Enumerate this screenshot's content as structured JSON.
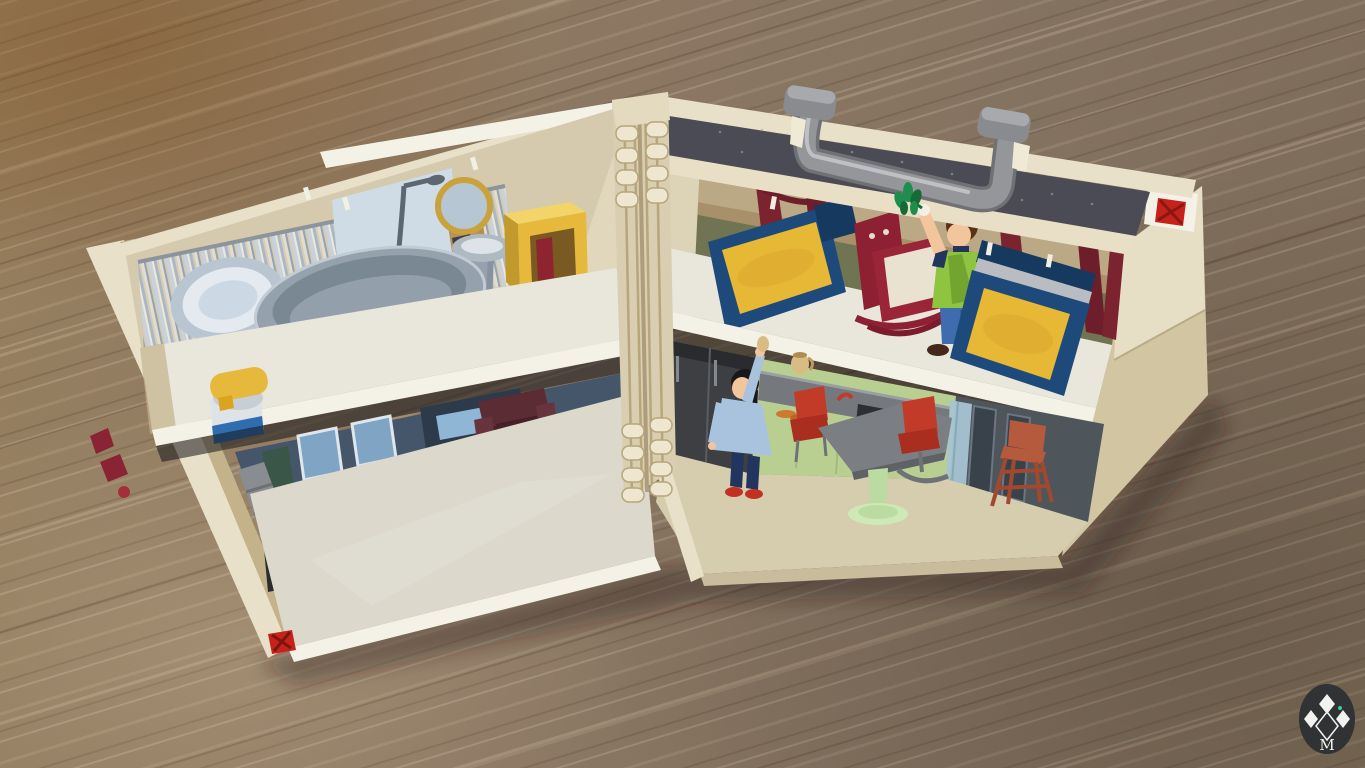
{
  "scene": {
    "type": "photograph",
    "subject": "Playmobil take-along dollhouse opened to show four furnished rooms, standing on a diagonal wooden plank floor",
    "rooms": [
      {
        "id": "bathroom",
        "position": "upper-left",
        "items": [
          "bathtub",
          "pedestal-sink",
          "round-mirror",
          "yellow-cabinet",
          "toilet",
          "round-window-print",
          "shower-print",
          "striped-wallpaper"
        ]
      },
      {
        "id": "living-room",
        "position": "lower-left",
        "items": [
          "armchair",
          "armchair",
          "tv-panel",
          "black-sideboard",
          "window-backdrop"
        ]
      },
      {
        "id": "bedroom",
        "position": "upper-right",
        "items": [
          "bed-with-yellow-blanket",
          "rocking-cradle",
          "boy-figure-with-plant",
          "bed-with-yellow-blanket",
          "curtain-landscape-mural"
        ]
      },
      {
        "id": "kitchen",
        "position": "lower-right",
        "items": [
          "refrigerator",
          "kitchen-counter-print",
          "woman-figure",
          "pedestal-table",
          "red-chair",
          "red-chair",
          "high-chair"
        ]
      }
    ],
    "hardware": [
      "carry-handle",
      "hinge-column",
      "left-edge-latch",
      "corner-knob-left",
      "corner-knob-right"
    ]
  },
  "watermark": {
    "monogram": "M"
  },
  "colors": {
    "wood_base": "#8d7963",
    "shell_cream": "#e8e0c9",
    "shell_cream_light": "#f4f1e6",
    "shell_tan": "#c3b28a",
    "shell_beige": "#d2c5a2",
    "fascia_beige": "#c8bc9c",
    "roof_dark": "#4a4b54",
    "handle_gray": "#94969a",
    "handle_gray_dark": "#6f7175",
    "tub_gray": "#95a1ad",
    "tub_gray_deep": "#7a8894",
    "fixture_yellow": "#e6b93c",
    "cabinet_yellow_dark": "#c1992c",
    "mirror_gold": "#c9a23c",
    "toilet_blue": "#2f6db0",
    "bed_blue": "#1d4a7b",
    "bed_blue_dark": "#16395f",
    "blanket_yellow": "#e7b736",
    "silver": "#b9bdc1",
    "cradle_red": "#8e2033",
    "armchair_burgundy": "#5c2c35",
    "armchair_burgundy_dark": "#4a2129",
    "tv_black": "#2b2c30",
    "tv_gray": "#898c90",
    "backdrop_blue": "#46566a",
    "window_blue": "#7fa4c4",
    "kitchen_green": "#b9cf92",
    "counter_gray": "#75797e",
    "fridge_dark": "#3d3f43",
    "cooktop_black": "#2e2f33",
    "chair_red": "#c23a28",
    "table_gray": "#7b7f83",
    "table_base_green": "#bcdba2",
    "highchair_terracotta": "#b65a3e",
    "skin": "#f2c59c",
    "hand_white": "#f3efe6",
    "boy_hair": "#5a3018",
    "boy_vest": "#8ec440",
    "jeans_blue": "#3f6cae",
    "navy": "#22355e",
    "woman_top": "#a9c2de",
    "woman_hair": "#17171c",
    "shoe_red": "#c23022",
    "shoe_brown": "#44291a",
    "latch_red": "#8a2434",
    "knob_red": "#c6221c",
    "mural_tan": "#a8906a",
    "mural_olive": "#66704e",
    "mural_sky": "#bfae8c",
    "curtain_red": "#7c2330",
    "curtain_blue": "#a6c4d2",
    "bath_wall": "#d5c9ae",
    "floor_white": "#e9e6dc",
    "floor_beige": "#d6ccae",
    "plant_green": "#1f8e4d",
    "plate_orange": "#cc7a30",
    "jug_tan": "#d9bc84",
    "watermark_bg": "#2c2f33",
    "watermark_fg": "#f2f2f0"
  }
}
